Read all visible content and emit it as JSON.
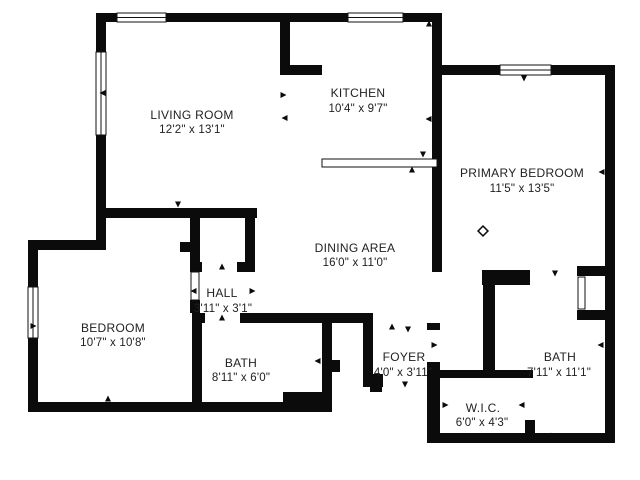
{
  "floor_plan": {
    "title": "Apartment floor plan",
    "rooms": {
      "living_room": {
        "name": "LIVING ROOM",
        "dimensions": "12'2\" x 13'1\""
      },
      "kitchen": {
        "name": "KITCHEN",
        "dimensions": "10'4\" x 9'7\""
      },
      "primary_bedroom": {
        "name": "PRIMARY BEDROOM",
        "dimensions": "11'5\" x 13'5\""
      },
      "dining_area": {
        "name": "DINING AREA",
        "dimensions": "16'0\" x 11'0\""
      },
      "hall": {
        "name": "HALL",
        "dimensions": "3'11\" x 3'1\""
      },
      "bedroom": {
        "name": "BEDROOM",
        "dimensions": "10'7\" x 10'8\""
      },
      "bath": {
        "name": "BATH",
        "dimensions": "8'11\" x 6'0\""
      },
      "foyer": {
        "name": "FOYER",
        "dimensions": "4'0\" x 3'11\""
      },
      "primary_bath": {
        "name": "BATH",
        "dimensions": "7'11\" x 11'1\""
      },
      "walk_in_closet": {
        "name": "W.I.C.",
        "dimensions": "6'0\" x 4'3\""
      }
    },
    "colors": {
      "wall": "#0b0b0b",
      "background": "#ffffff",
      "text": "#212121"
    }
  }
}
